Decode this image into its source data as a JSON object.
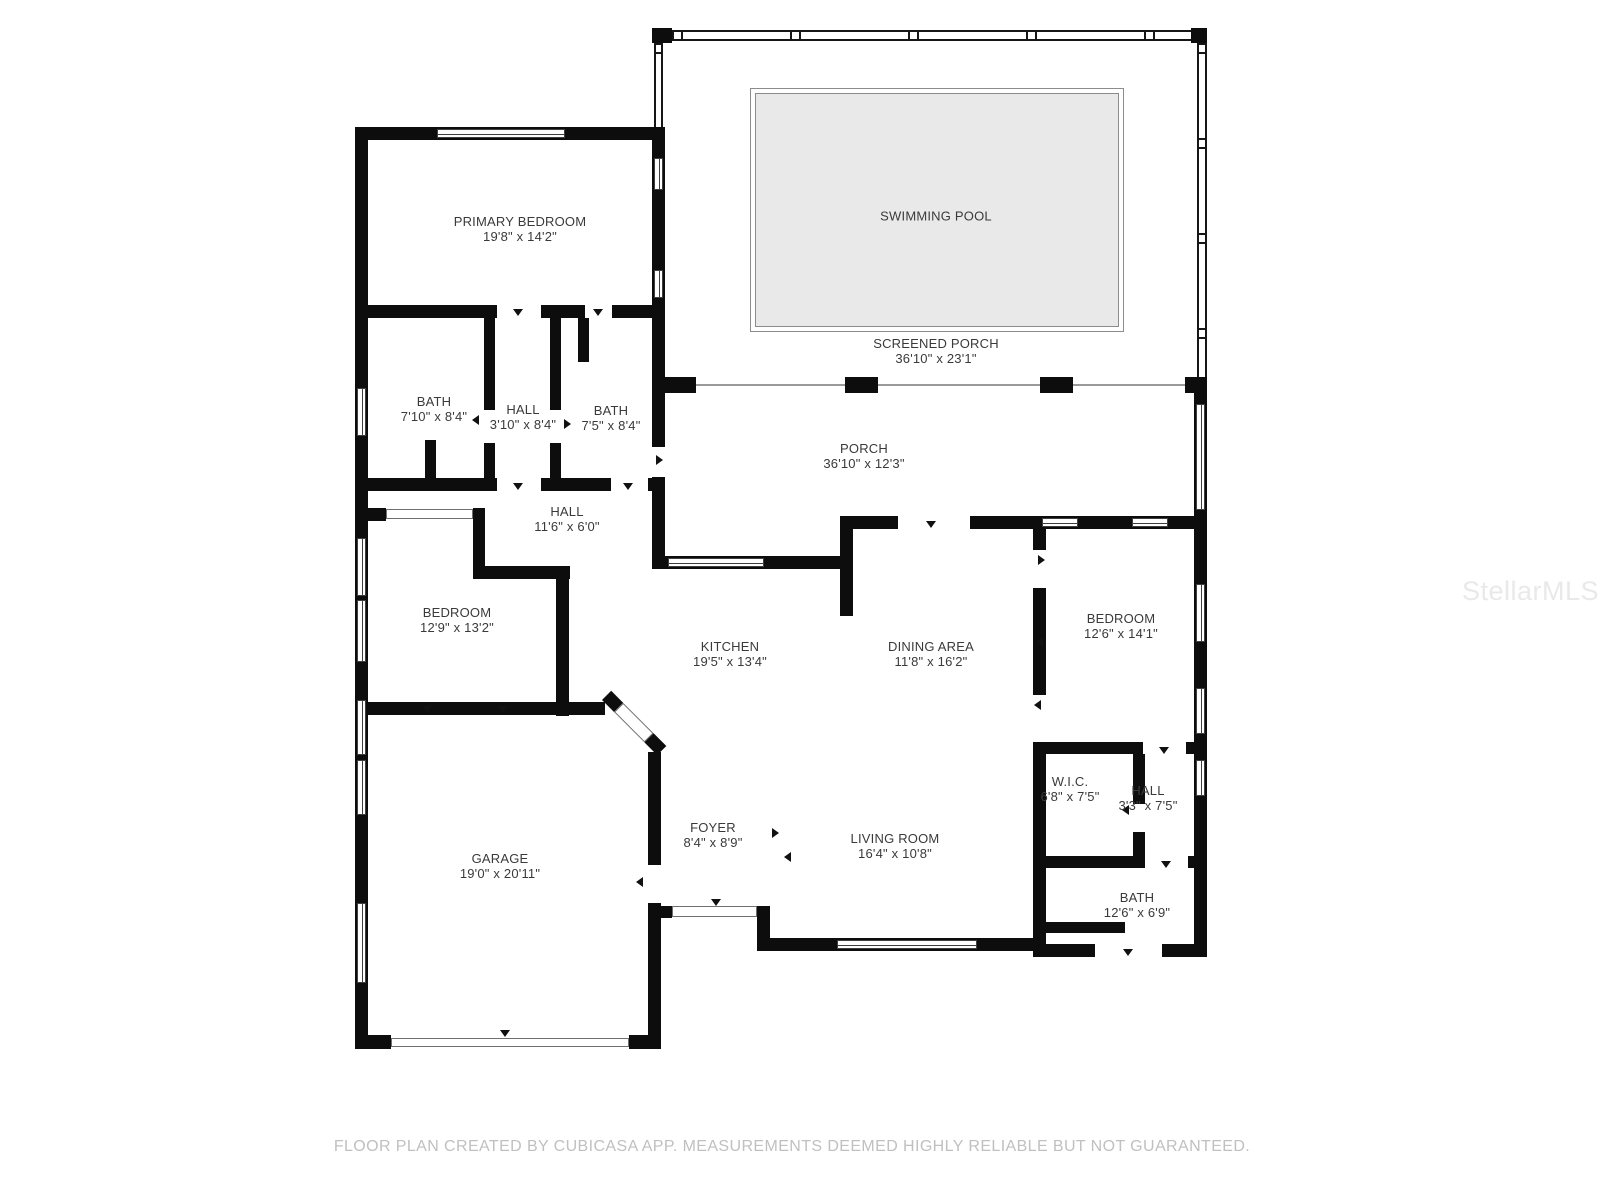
{
  "watermark": "StellarMLS",
  "footer": {
    "disclaimer": "FLOOR PLAN CREATED BY CUBICASA APP. MEASUREMENTS DEEMED HIGHLY RELIABLE BUT NOT GUARANTEED."
  },
  "rooms": {
    "primary_bedroom": {
      "name": "PRIMARY BEDROOM",
      "dims": "19'8\" x 14'2\""
    },
    "swimming_pool": {
      "name": "SWIMMING POOL"
    },
    "screened_porch": {
      "name": "SCREENED PORCH",
      "dims": "36'10\" x 23'1\""
    },
    "bath_left": {
      "name": "BATH",
      "dims": "7'10\" x 8'4\""
    },
    "hall_small": {
      "name": "HALL",
      "dims": "3'10\" x 8'4\""
    },
    "bath_mid": {
      "name": "BATH",
      "dims": "7'5\" x 8'4\""
    },
    "porch": {
      "name": "PORCH",
      "dims": "36'10\" x 12'3\""
    },
    "hall_main": {
      "name": "HALL",
      "dims": "11'6\" x 6'0\""
    },
    "bedroom_left": {
      "name": "BEDROOM",
      "dims": "12'9\" x 13'2\""
    },
    "kitchen": {
      "name": "KITCHEN",
      "dims": "19'5\" x 13'4\""
    },
    "dining": {
      "name": "DINING AREA",
      "dims": "11'8\" x 16'2\""
    },
    "bedroom_right": {
      "name": "BEDROOM",
      "dims": "12'6\" x 14'1\""
    },
    "wic": {
      "name": "W.I.C.",
      "dims": "6'8\" x 7'5\""
    },
    "hall_right": {
      "name": "HALL",
      "dims": "3'3\" x 7'5\""
    },
    "foyer": {
      "name": "FOYER",
      "dims": "8'4\" x 8'9\""
    },
    "living": {
      "name": "LIVING ROOM",
      "dims": "16'4\" x 10'8\""
    },
    "garage": {
      "name": "GARAGE",
      "dims": "19'0\" x 20'11\""
    },
    "bath_right": {
      "name": "BATH",
      "dims": "12'6\" x 6'9\""
    }
  },
  "colors": {
    "wall": "#0d0d0d",
    "pool_fill": "#e9e9e9",
    "label_text": "#3a3a3a",
    "watermark": "#e9e9e9",
    "disclaimer": "#c0c0c0"
  }
}
